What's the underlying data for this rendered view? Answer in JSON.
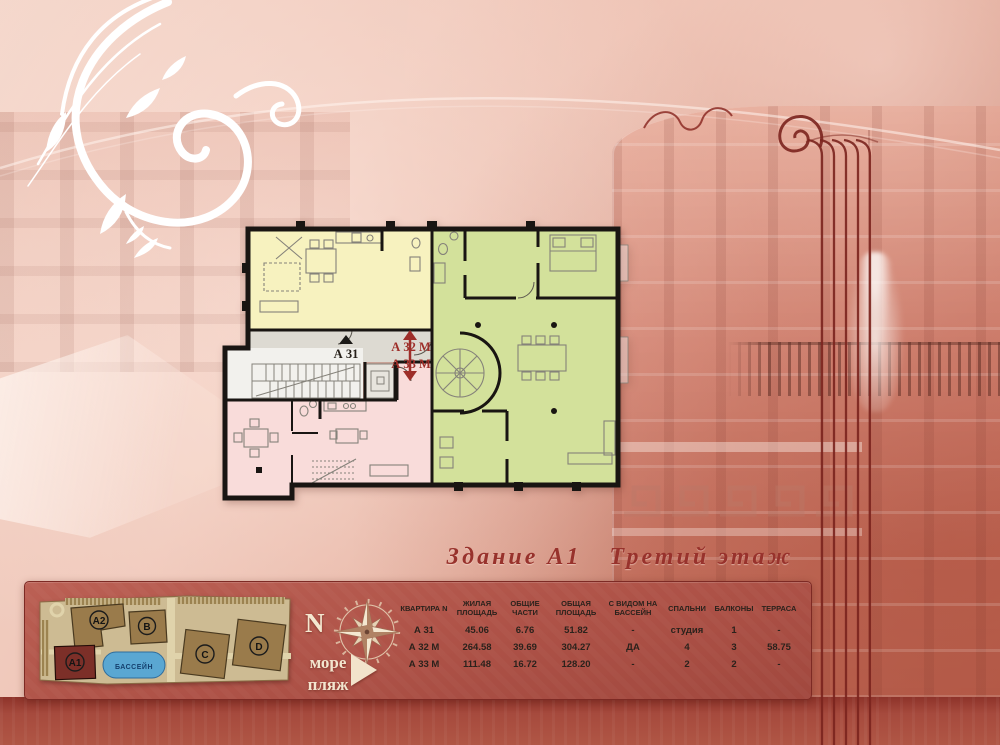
{
  "page": {
    "title_part1": "Здание А1",
    "title_part2": "Третий этаж"
  },
  "floor_plan": {
    "apartments": [
      {
        "id": "a31",
        "label": "А 31",
        "color": "#f7f2bf"
      },
      {
        "id": "a32m",
        "label": "А 32 М",
        "color": "#d3e19b"
      },
      {
        "id": "a33m",
        "label": "А 33 М",
        "color": "#f9dcda"
      }
    ]
  },
  "site_map": {
    "pool_label": "БАССЕЙН",
    "buildings": [
      {
        "label": "А2"
      },
      {
        "label": "В"
      },
      {
        "label": "А1",
        "highlighted": true
      },
      {
        "label": "С"
      },
      {
        "label": "D"
      }
    ]
  },
  "compass": {
    "north": "N",
    "sea": "море",
    "beach": "пляж"
  },
  "apartments_table": {
    "headers": [
      "КВАРТИРА N",
      "ЖИЛАЯ ПЛОЩАДЬ",
      "ОБЩИЕ ЧАСТИ",
      "ОБЩАЯ ПЛОЩАДЬ",
      "С ВИДОМ НА БАССЕЙН",
      "СПАЛЬНИ",
      "БАЛКОНЫ",
      "ТЕРРАСА"
    ],
    "rows": [
      [
        "А 31",
        "45.06",
        "6.76",
        "51.82",
        "-",
        "студия",
        "1",
        "-"
      ],
      [
        "А 32 М",
        "264.58",
        "39.69",
        "304.27",
        "ДА",
        "4",
        "3",
        "58.75"
      ],
      [
        "А 33 М",
        "111.48",
        "16.72",
        "128.20",
        "-",
        "2",
        "2",
        "-"
      ]
    ]
  },
  "colors": {
    "accent_red": "#9e2e29",
    "panel_red": "#b05449",
    "pool_blue": "#5aa7d2",
    "building_brown": "#9a7b4b",
    "a1_building_red": "#7c2f28"
  }
}
